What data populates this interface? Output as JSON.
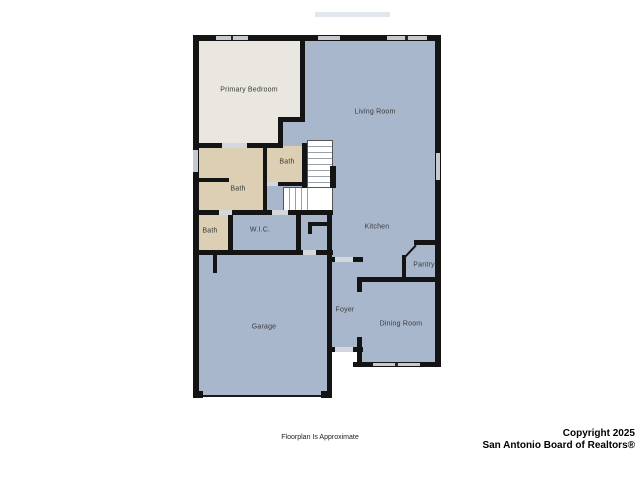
{
  "image_type": "residential-floorplan",
  "palette": {
    "background": "#ffffff",
    "wall": "#141414",
    "room_blue": "#a9b7cc",
    "room_cream": "#e9e7e0",
    "room_tan": "#dccfb3",
    "window_marker": "#c6cacf",
    "door_opening": "#d4d8de"
  },
  "rooms": [
    {
      "id": "primary-bedroom",
      "label": "Primary Bedroom",
      "cx": 249,
      "cy": 90
    },
    {
      "id": "living-room",
      "label": "Living Room",
      "cx": 375,
      "cy": 112
    },
    {
      "id": "bath-upper",
      "label": "Bath",
      "cx": 287,
      "cy": 162
    },
    {
      "id": "bath-main",
      "label": "Bath",
      "cx": 238,
      "cy": 189
    },
    {
      "id": "bath-lower",
      "label": "Bath",
      "cx": 210,
      "cy": 231
    },
    {
      "id": "wic",
      "label": "W.I.C.",
      "cx": 260,
      "cy": 230
    },
    {
      "id": "kitchen",
      "label": "Kitchen",
      "cx": 377,
      "cy": 227
    },
    {
      "id": "pantry",
      "label": "Pantry",
      "cx": 424,
      "cy": 265
    },
    {
      "id": "foyer",
      "label": "Foyer",
      "cx": 345,
      "cy": 310
    },
    {
      "id": "garage",
      "label": "Garage",
      "cx": 264,
      "cy": 327
    },
    {
      "id": "dining-room",
      "label": "Dining Room",
      "cx": 401,
      "cy": 324
    }
  ],
  "footer": {
    "disclaimer": "Floorplan Is Approximate",
    "copyright_line1": "Copyright 2025",
    "copyright_line2": "San Antonio Board of Realtors®"
  }
}
